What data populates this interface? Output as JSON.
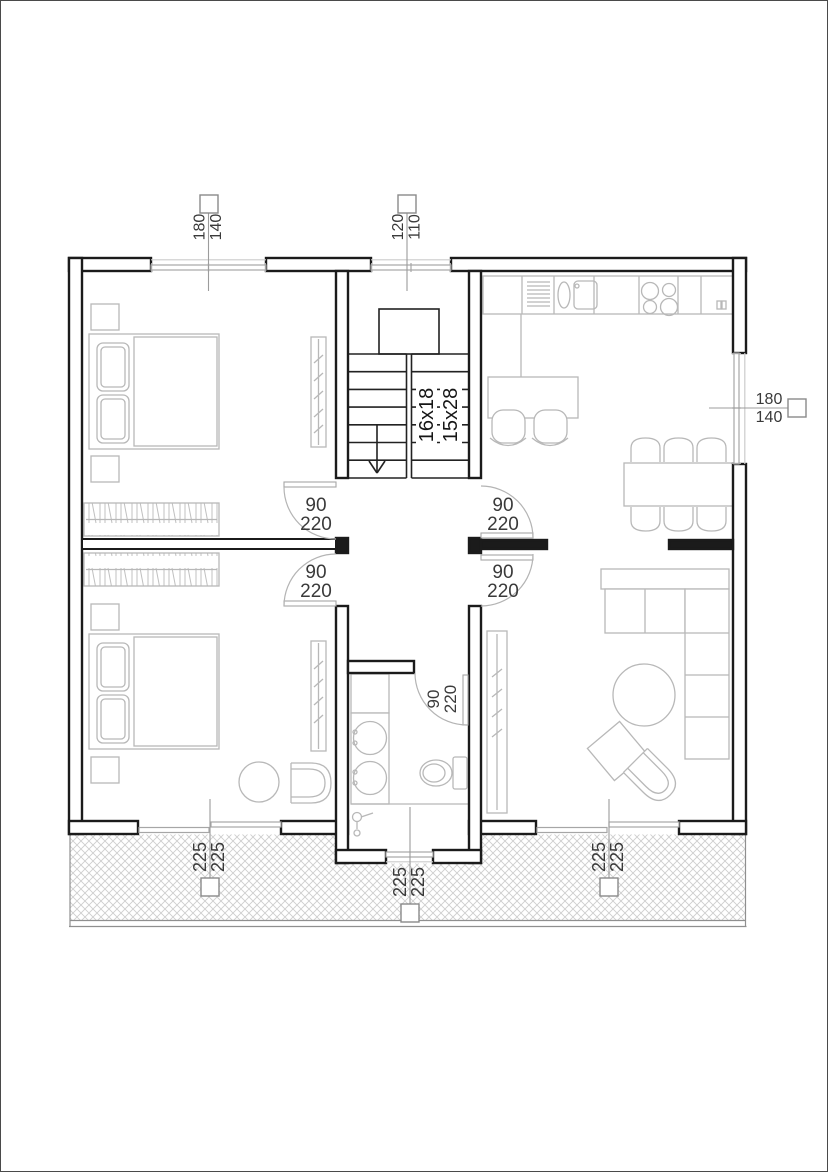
{
  "drawing_type": "architectural-floor-plan",
  "colors": {
    "wall": "#1b1b1b",
    "furniture_line": "#b8b8b8",
    "opening_line": "#a6a6a6",
    "hatch_line": "#cdcdcd",
    "leader_line": "#9c9c9c",
    "label_text": "#3a3a3a"
  },
  "dim": {
    "win_top_bedroom": {
      "a": "180",
      "b": "140"
    },
    "win_top_stairs": {
      "a": "120",
      "b": "110"
    },
    "win_right_kitchen": {
      "a": "180",
      "b": "140"
    },
    "door_bedroom1": {
      "a": "90",
      "b": "220"
    },
    "door_kitchen": {
      "a": "90",
      "b": "220"
    },
    "door_bedroom2": {
      "a": "90",
      "b": "220"
    },
    "door_living": {
      "a": "90",
      "b": "220"
    },
    "door_bathroom": {
      "a": "90",
      "b": "220"
    },
    "slider_bedroom2": {
      "a": "225",
      "b": "225"
    },
    "win_bathroom": {
      "a": "225",
      "b": "225"
    },
    "slider_living": {
      "a": "225",
      "b": "225"
    }
  },
  "stairs": {
    "flight_a": "16x18",
    "flight_b": "15x28"
  },
  "rooms": {
    "bedroom1_items": [
      "bed",
      "pillows",
      "nightstands",
      "wardrobe",
      "radiator"
    ],
    "bedroom2_items": [
      "bed",
      "pillows",
      "nightstands",
      "wardrobe",
      "radiator",
      "side-table",
      "tub-chair"
    ],
    "kitchen_items": [
      "counter",
      "drainer",
      "sink",
      "cooktop",
      "island",
      "bar-stools",
      "dining-table",
      "six-chairs"
    ],
    "living_items": [
      "corner-sofa",
      "coffee-table",
      "armchair",
      "ottoman",
      "radiator"
    ],
    "bathroom_items": [
      "washer",
      "double-vanity",
      "toilet",
      "shower"
    ]
  }
}
